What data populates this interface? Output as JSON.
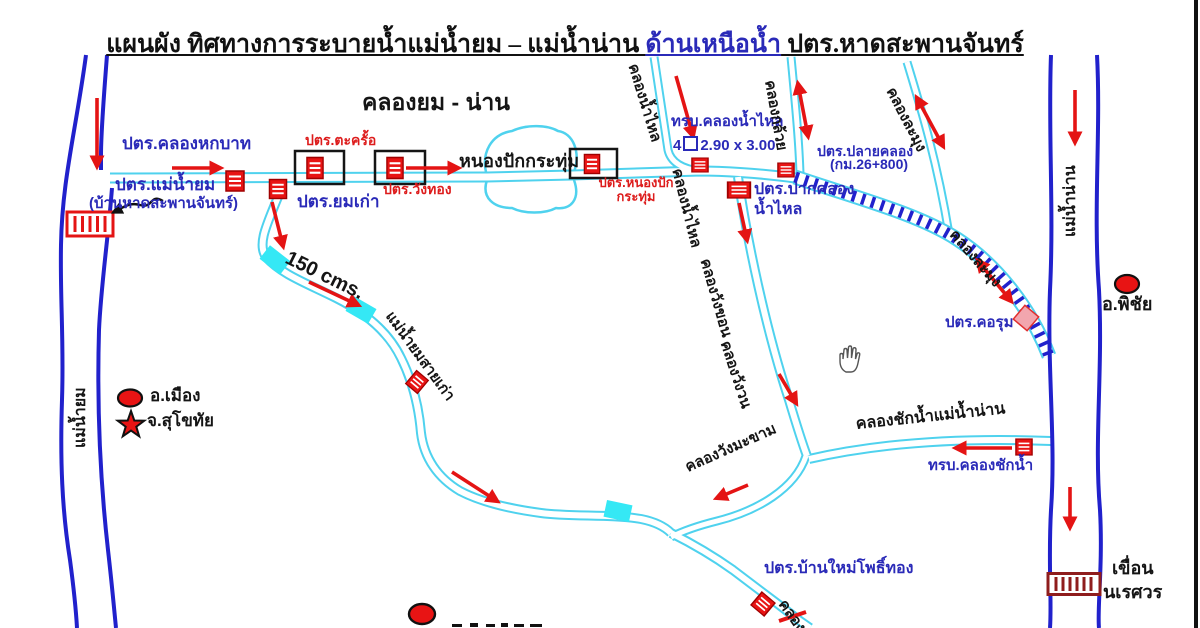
{
  "title": {
    "part1": "แผนผัง ทิศทางการระบายน้ำแม่น้ำยม – แม่น้ำน่าน ",
    "part2_blue": "ด้านเหนือน้ำ",
    "part3": " ปตร.หาดสะพานจันทร์"
  },
  "colors": {
    "river_blue": "#2121cc",
    "canal_cyan": "#4fd2ee",
    "bridge_cyan": "#35e8f5",
    "arrow_red": "#e41414",
    "label_blue": "#2a2ab8",
    "label_red": "#dd1c1c",
    "label_black": "#151515",
    "dam_maroon": "#8f1d1d",
    "gate_pink": "#f2a6ae"
  },
  "map_labels": {
    "klong_yom_nan_title": "คลองยม - น่าน",
    "ptr_klong_hok_bat": "ปตร.คลองหกบาท",
    "ptr_mae_nam_yom": "ปตร.แม่น้ำยม",
    "ptr_mae_nam_yom_sub": "(บ้านหาดสะพานจันทร์)",
    "ptr_yom_kao": "ปตร.ยมเก่า",
    "ptr_takro": "ปตร.ตะครั้อ",
    "ptr_wang_thong": "ปตร.วังทอง",
    "nong_pak_kratum": "หนองปักกระทุ่ม",
    "ptr_nong_pak_line1": "ปตร.หนองปัก",
    "ptr_nong_pak_line2": "กระทุ่ม",
    "trb_klong_nam_lai": "ทรบ.คลองน้ำไหล",
    "klong_nam_lai_upper": "คลองน้ำไหล",
    "klong_kluay": "คลองกล้วย",
    "klong_lamung_upper": "คลองละมุง",
    "ptr_pak_klong_line1": "ปตร.ปากคลอง",
    "ptr_pak_klong_line2": "น้ำไหล",
    "ptr_plai_klong_line1": "ปตร.ปลายคลอง",
    "ptr_plai_klong_line2": "(กม.26+800)",
    "klong_lamung_lower": "คลองละมุง",
    "ptr_korum": "ปตร.คอรุม",
    "a_phichai": "อ.พิชัย",
    "mae_nam_nan": "แม่น้ำน่าน",
    "mae_nam_yom": "แม่น้ำยม",
    "mae_nam_yom_sai_kao": "แม่น้ำยมสายเก่า",
    "klong_nam_lai_lower": "คลองน้ำไหล",
    "klong_wang_khon": "คลองวังขอน",
    "klong_wang_won": "คลองวังวน",
    "klong_chak_nam": "คลองชักน้ำแม่น้ำน่าน",
    "trb_klong_chak_nam": "ทรบ.คลองชักน้ำ",
    "klong_wang_makham": "คลองวังมะขาม",
    "ptr_ban_mai_pho_thong": "ปตร.บ้านใหม่โพธิ์ทอง",
    "khuean_line1": "เขื่อน",
    "khuean_line2": "นเรศวร",
    "klong_bottom_partial": "คลอง"
  },
  "legend": {
    "district": "อ.เมือง",
    "province": "จ.สุโขทัย"
  },
  "flow_capacity": "150 cms.",
  "culvert_spec": {
    "count": "4",
    "size": "2.90 x 3.00"
  }
}
